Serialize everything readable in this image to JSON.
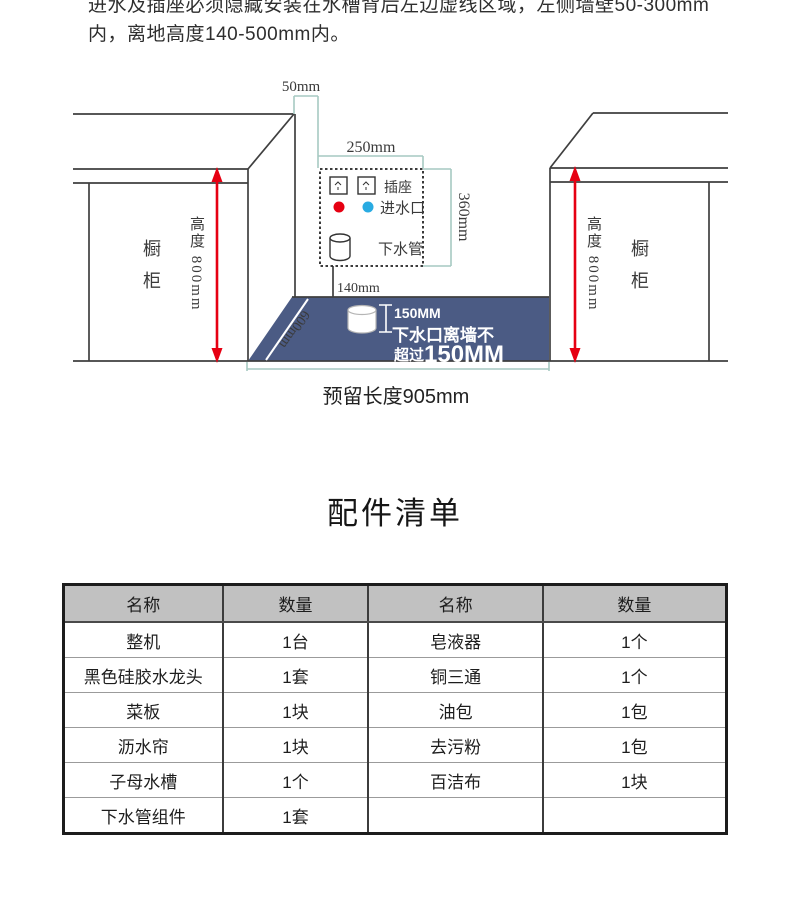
{
  "note": {
    "line1": "进水及插座必须隐藏安装在水槽背后左边虚线区域，左侧墙壁50-300mm",
    "line2": "内，离地高度140-500mm内。"
  },
  "diagram": {
    "dim_50": "50mm",
    "dim_250": "250mm",
    "dim_360": "360mm",
    "dim_140": "140mm",
    "dim_600": "600mm",
    "socket_label": "插座",
    "inlet_label": "进水口",
    "drain_label": "下水管",
    "cabinet_label": "橱柜",
    "height_label": "高度 800mm",
    "blue_dim": "150MM",
    "blue_note_line1": "下水口离墙不",
    "blue_note_line2a": "超过",
    "blue_note_line2b": "150MM",
    "reserved_label": "预留长度905mm",
    "colors": {
      "floor_blue": "#4b5b84",
      "dim_teal": "#a6c9c2",
      "arrow_red": "#e60012",
      "hot_dot": "#e60012",
      "cold_dot": "#29abe2"
    }
  },
  "parts": {
    "title": "配件清单",
    "headers": [
      "名称",
      "数量",
      "名称",
      "数量"
    ],
    "rows": [
      [
        "整机",
        "1台",
        "皂液器",
        "1个"
      ],
      [
        "黑色硅胶水龙头",
        "1套",
        "铜三通",
        "1个"
      ],
      [
        "菜板",
        "1块",
        "油包",
        "1包"
      ],
      [
        "沥水帘",
        "1块",
        "去污粉",
        "1包"
      ],
      [
        "子母水槽",
        "1个",
        "百洁布",
        "1块"
      ],
      [
        "下水管组件",
        "1套",
        "",
        ""
      ]
    ]
  }
}
